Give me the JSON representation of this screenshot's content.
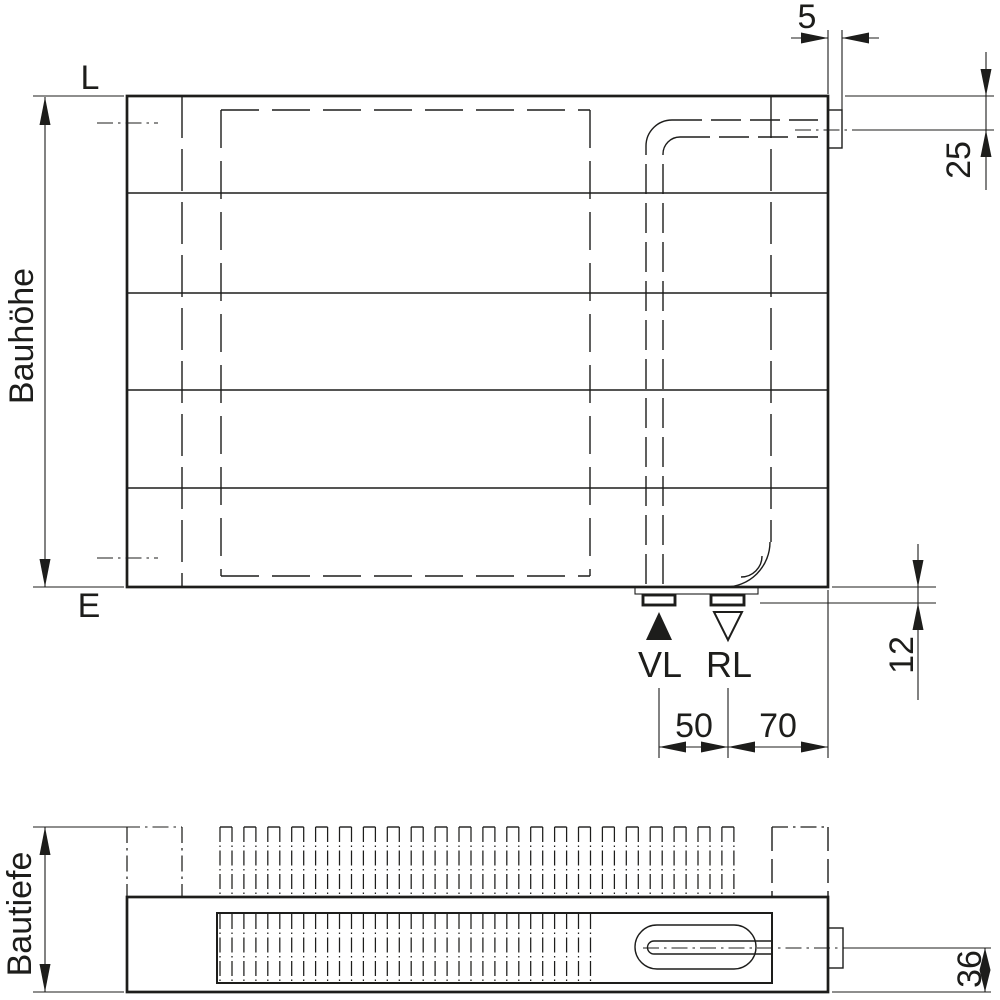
{
  "front_view": {
    "label_top_edge": "L",
    "label_bottom_edge": "E",
    "dim_height_label": "Bauhöhe",
    "dim_tab_width": "5",
    "dim_valve_center_offset": "25",
    "dim_stub_height": "12",
    "dim_supply_to_return": "50",
    "dim_return_to_edge": "70",
    "label_supply": "VL",
    "label_return": "RL"
  },
  "top_view": {
    "dim_depth_label": "Bautiefe",
    "dim_pipe_center_to_bottom": "36"
  },
  "colors": {
    "line": "#1d1d1b",
    "background": "#ffffff"
  }
}
